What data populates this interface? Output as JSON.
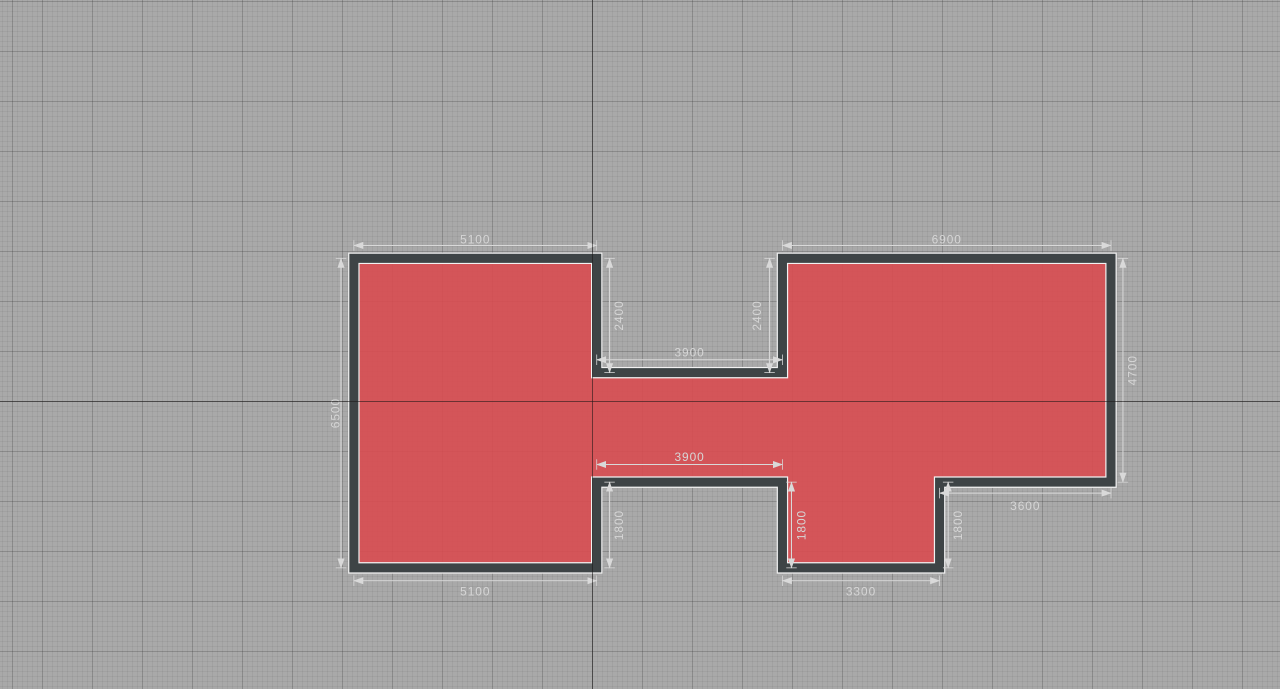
{
  "canvas": {
    "width_px": 1280,
    "height_px": 689,
    "colors": {
      "background": "#a9a9a9",
      "grid_major": "#8f8f8f",
      "grid_minor": "#a0a0a0",
      "axis": "#2a2828",
      "room_fill": "#d84b50",
      "wall": "#3e4446",
      "wall_outline": "#f2f2f2",
      "dimension": "#d6d6d6"
    },
    "origin_axis_px": {
      "x": 592,
      "y": 401
    },
    "grid_minor_px": 5,
    "grid_major_px": 50
  },
  "plan": {
    "units": "mm",
    "outline_points": "0,0 5100,0 5100,2400 9000,2400 9000,0 15900,0 15900,4700 12300,4700 12300,6500 9000,6500 9000,4700 5100,4700 5100,6500 0,6500",
    "outline_mm": [
      [
        0,
        0
      ],
      [
        5100,
        0
      ],
      [
        5100,
        2400
      ],
      [
        9000,
        2400
      ],
      [
        9000,
        0
      ],
      [
        15900,
        0
      ],
      [
        15900,
        4700
      ],
      [
        12300,
        4700
      ],
      [
        12300,
        6500
      ],
      [
        9000,
        6500
      ],
      [
        9000,
        4700
      ],
      [
        5100,
        4700
      ],
      [
        5100,
        6500
      ],
      [
        0,
        6500
      ]
    ]
  },
  "dimensions": [
    {
      "id": "top-left-width",
      "label": "5100",
      "orientation": "horizontal"
    },
    {
      "id": "top-right-width",
      "label": "6900",
      "orientation": "horizontal"
    },
    {
      "id": "upper-notch-left-depth",
      "label": "2400",
      "orientation": "vertical"
    },
    {
      "id": "upper-notch-right-depth",
      "label": "2400",
      "orientation": "vertical"
    },
    {
      "id": "upper-notch-width",
      "label": "3900",
      "orientation": "horizontal"
    },
    {
      "id": "left-height",
      "label": "6500",
      "orientation": "vertical"
    },
    {
      "id": "lower-notch-width",
      "label": "3900",
      "orientation": "horizontal"
    },
    {
      "id": "lower-notch-depth",
      "label": "1800",
      "orientation": "vertical"
    },
    {
      "id": "bottom-projection-height",
      "label": "1800",
      "orientation": "vertical"
    },
    {
      "id": "right-step-height",
      "label": "1800",
      "orientation": "vertical"
    },
    {
      "id": "right-lower-width",
      "label": "3600",
      "orientation": "horizontal"
    },
    {
      "id": "right-height",
      "label": "4700",
      "orientation": "vertical"
    },
    {
      "id": "bottom-left-width",
      "label": "5100",
      "orientation": "horizontal"
    },
    {
      "id": "bottom-projection-width",
      "label": "3300",
      "orientation": "horizontal"
    }
  ]
}
